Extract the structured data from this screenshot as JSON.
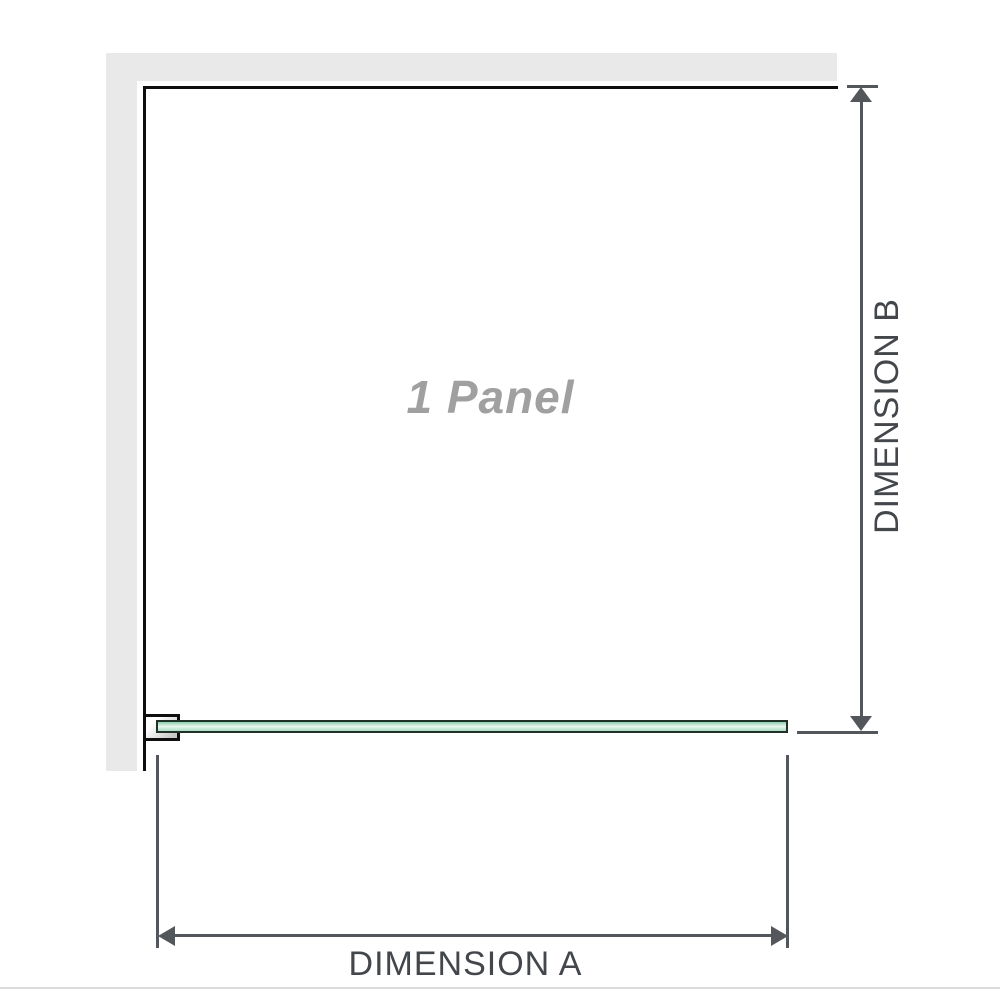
{
  "diagram": {
    "type": "shower-screen-panel-dimension-diagram",
    "panel_label": "1 Panel",
    "dimension_a": {
      "label": "DIMENSION A",
      "measures": "panel width (horizontal)"
    },
    "dimension_b": {
      "label": "DIMENSION B",
      "measures": "panel height (vertical)"
    }
  },
  "colors": {
    "wall": "#e9e9e9",
    "outline": "#0e0e0e",
    "dimension": "#53565a",
    "dim_label_text": "#43474b",
    "panel_label_text": "#a0a0a0",
    "glass_border": "#203128",
    "glass_green": "#abdcc3",
    "glass_highlight": "#edf8f2",
    "bracket_fill": "#c6c6c6",
    "divider": "#dbdbdb"
  }
}
